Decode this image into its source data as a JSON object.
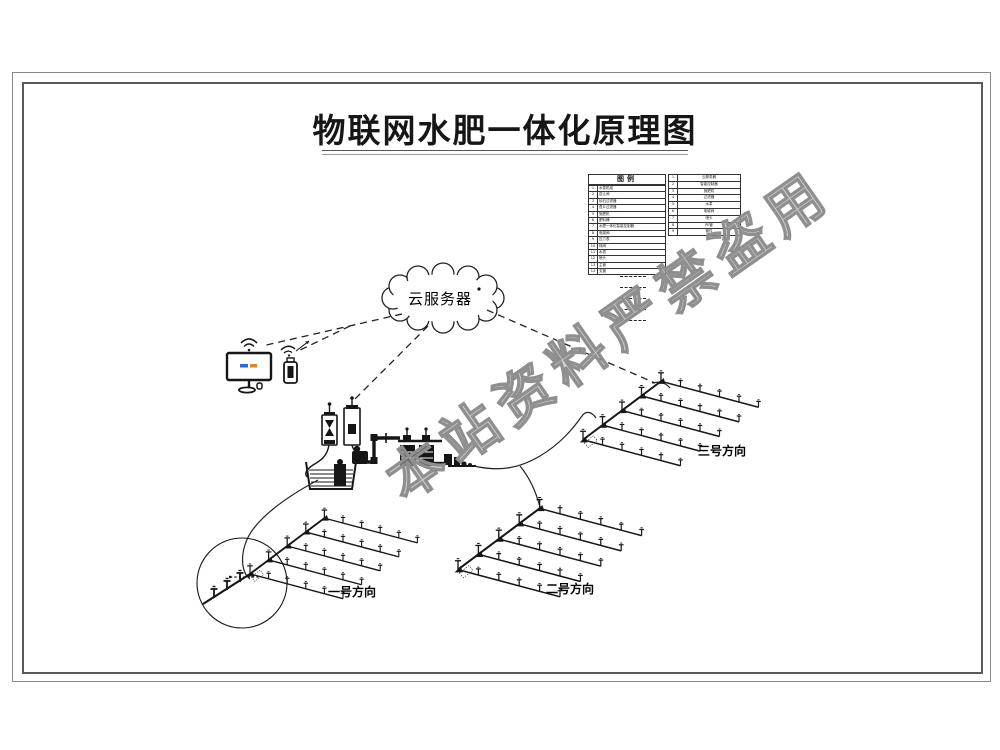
{
  "page": {
    "title": "物联网水肥一体化原理图",
    "watermark": "本站资料严禁盗用"
  },
  "cloud": {
    "label": "云服务器"
  },
  "fields": [
    {
      "label": "一号方向"
    },
    {
      "label": "二号方向"
    },
    {
      "label": "三号方向"
    }
  ],
  "legend": {
    "header": "图例",
    "rows": [
      {
        "no": "1",
        "label": "水泵机组"
      },
      {
        "no": "2",
        "label": "逆止阀"
      },
      {
        "no": "3",
        "label": "砂石过滤器"
      },
      {
        "no": "4",
        "label": "叠片过滤器"
      },
      {
        "no": "5",
        "label": "施肥机"
      },
      {
        "no": "6",
        "label": "肥料桶"
      },
      {
        "no": "7",
        "label": "水肥一体化智能控制器"
      },
      {
        "no": "8",
        "label": "电磁阀"
      },
      {
        "no": "9",
        "label": "压力表"
      },
      {
        "no": "10",
        "label": "球阀"
      },
      {
        "no": "11",
        "label": "水表"
      },
      {
        "no": "12",
        "label": "喷头"
      },
      {
        "no": "13",
        "label": "主管"
      },
      {
        "no": "14",
        "label": "支管"
      }
    ]
  },
  "materials": {
    "rows": [
      {
        "no": "1",
        "label": "云服务器"
      },
      {
        "no": "2",
        "label": "智能控制器"
      },
      {
        "no": "3",
        "label": "施肥机"
      },
      {
        "no": "4",
        "label": "过滤器"
      },
      {
        "no": "5",
        "label": "水泵"
      },
      {
        "no": "6",
        "label": "电磁阀"
      },
      {
        "no": "7",
        "label": "喷头"
      },
      {
        "no": "8",
        "label": "PE管"
      },
      {
        "no": "9",
        "label": "管件"
      }
    ]
  }
}
